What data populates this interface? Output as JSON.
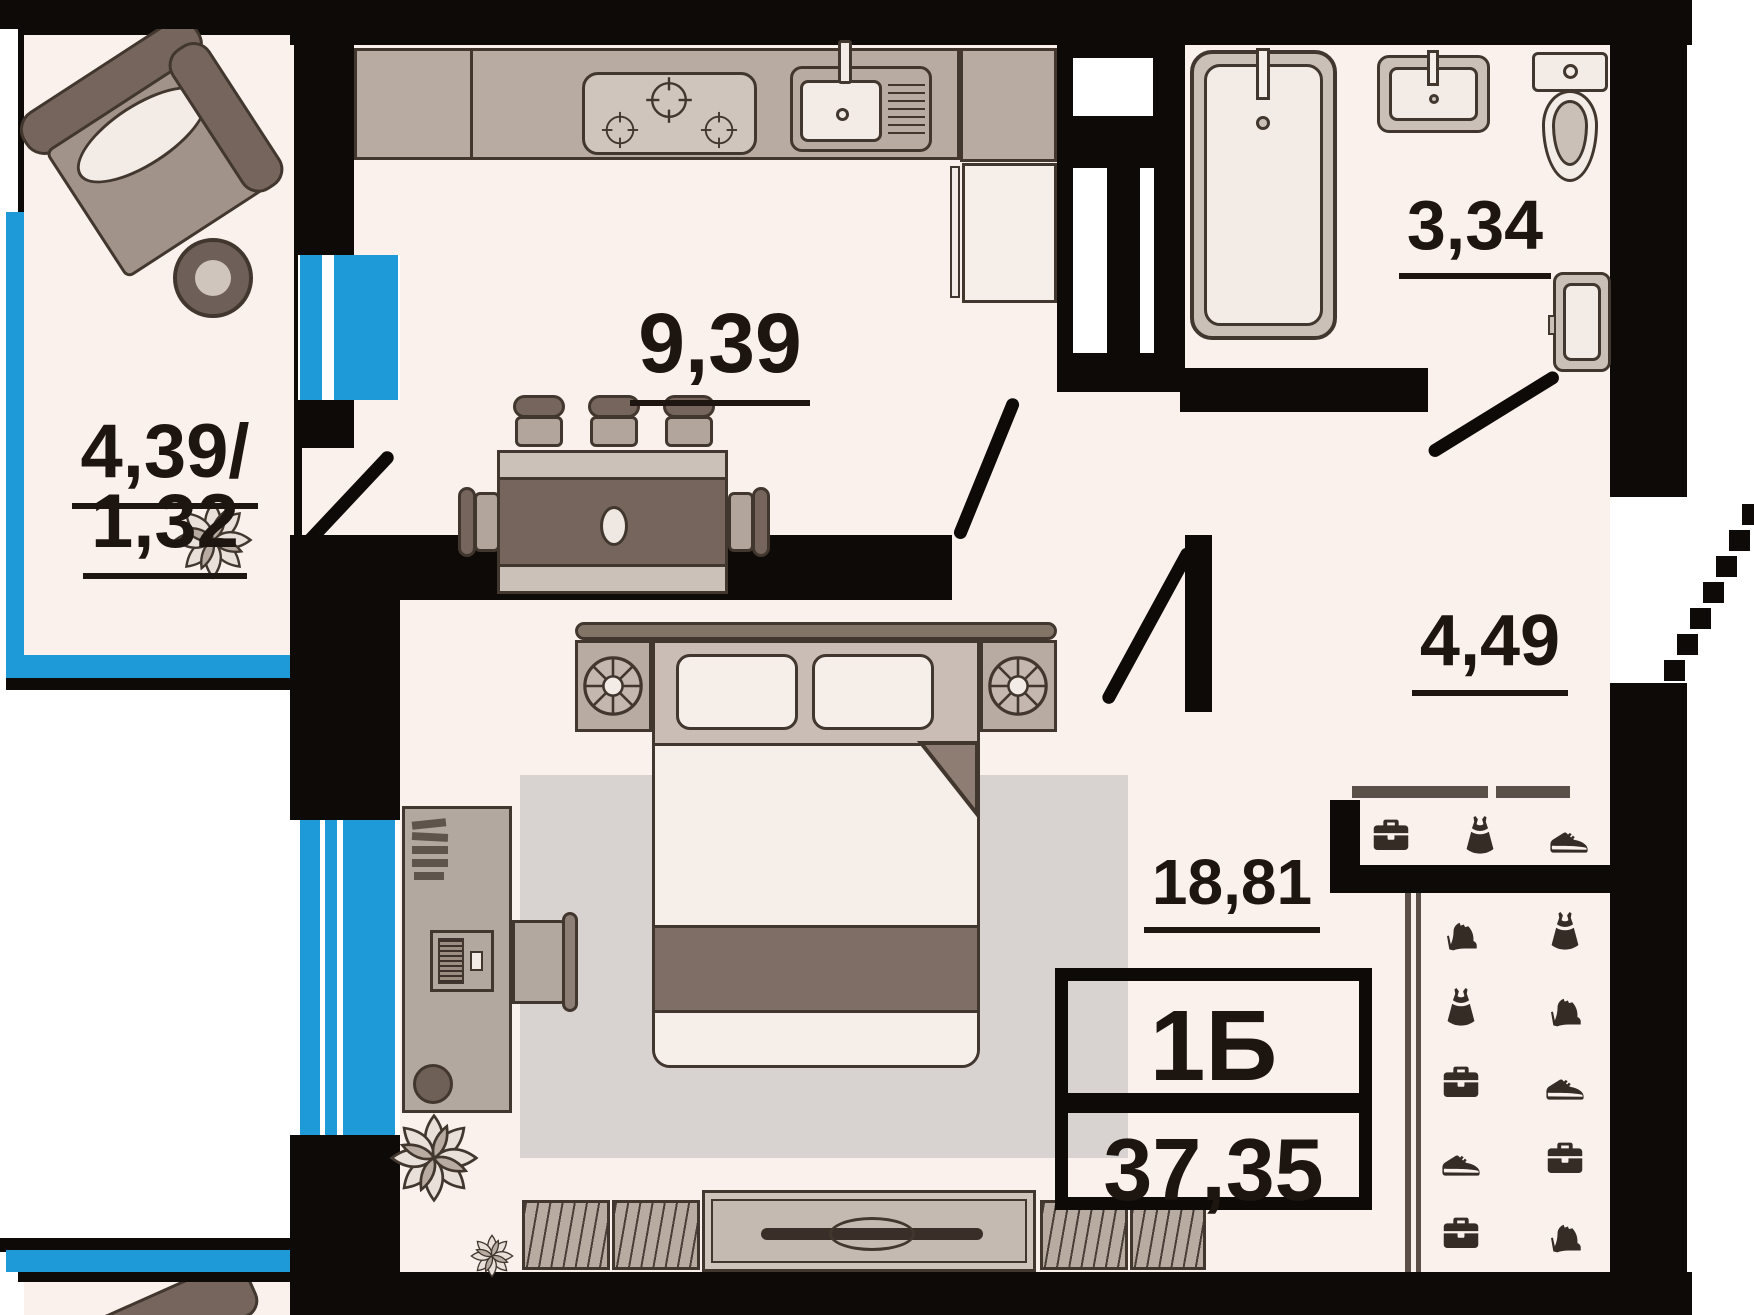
{
  "apartment": {
    "type_label": "1Б",
    "total_area": "37,35"
  },
  "rooms": {
    "kitchen": {
      "name": "kitchen",
      "area": "9,39"
    },
    "living": {
      "name": "living-room",
      "area": "18,81"
    },
    "hallway": {
      "name": "hallway",
      "area": "4,49"
    },
    "bathroom": {
      "name": "bathroom",
      "area": "3,34"
    },
    "balcony": {
      "name": "balcony",
      "area_total": "4,39/",
      "area_reduced": "1,32"
    }
  },
  "wardrobes": {
    "top": {
      "icons": [
        "briefcase-icon",
        "dress-icon",
        "sneaker-icon"
      ]
    },
    "side": {
      "icons": [
        "heel-icon",
        "dress-icon",
        "dress-icon",
        "heel-icon",
        "briefcase-icon",
        "sneaker-icon",
        "sneaker-icon",
        "briefcase-icon",
        "briefcase-icon",
        "heel-icon"
      ]
    }
  },
  "colors": {
    "walls": "#0d0a08",
    "floor": "#faf1ec",
    "window_blue": "#1e9ad9",
    "furniture_dark": "#75655c",
    "furniture_mid": "#b7aba2",
    "rug": "#d8d3d0",
    "label_text": "#1d1510"
  }
}
